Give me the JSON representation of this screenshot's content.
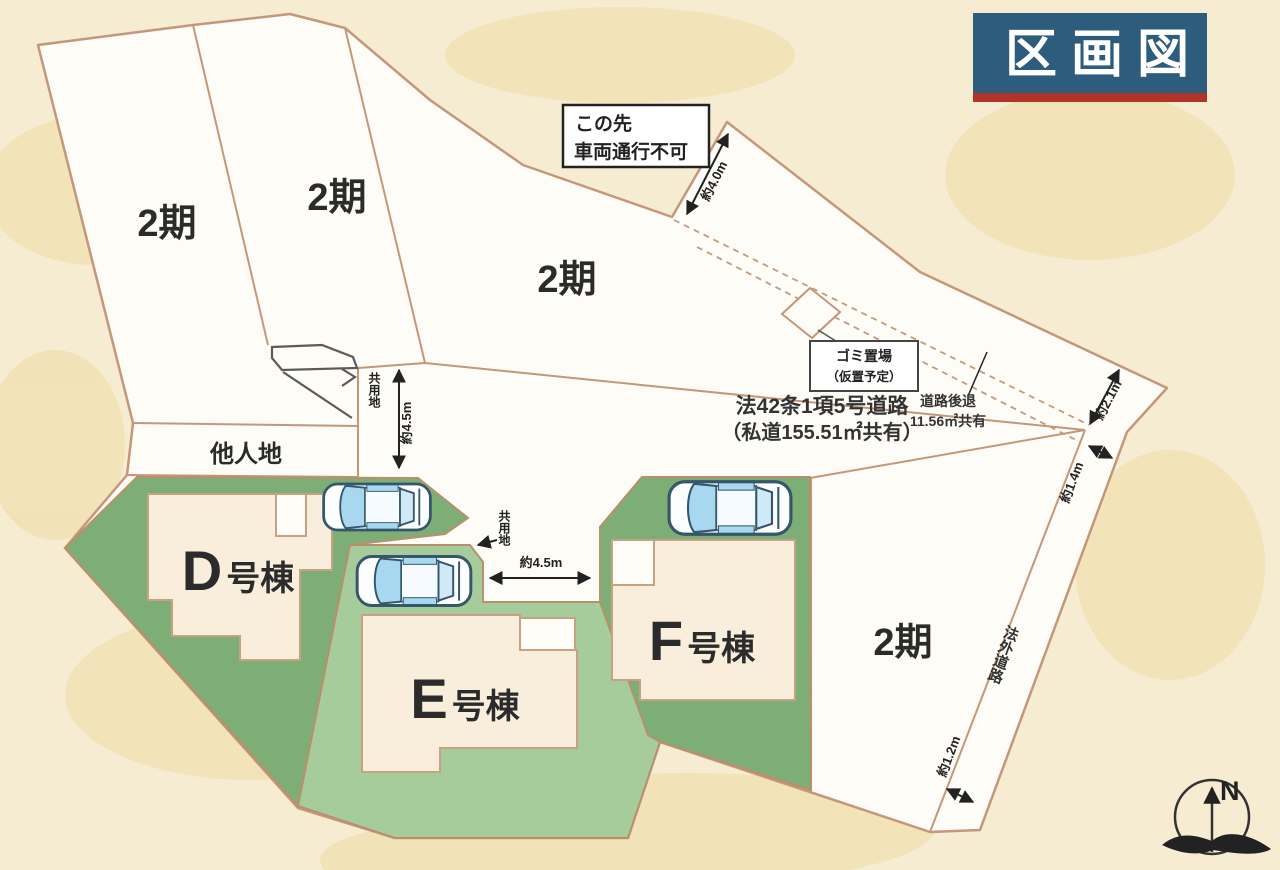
{
  "title": {
    "text": "区画図"
  },
  "lots": {
    "phase_label": "2期",
    "other_land": "他人地",
    "common_land": "共用地"
  },
  "buildings": {
    "d": {
      "letter": "D",
      "suffix": "号棟"
    },
    "e": {
      "letter": "E",
      "suffix": "号棟"
    },
    "f": {
      "letter": "F",
      "suffix": "号棟"
    }
  },
  "notice": {
    "line1": "この先",
    "line2": "車両通行不可"
  },
  "garbage": {
    "line1": "ゴミ置場",
    "line2": "（仮置予定）"
  },
  "road": {
    "line1": "法42条1項5号道路",
    "line2": "（私道155.51㎡共有）"
  },
  "setback": {
    "line1": "道路後退",
    "line2": "11.56㎡共有"
  },
  "outside_road": "法外道路",
  "dimensions": {
    "d40": "約4.0m",
    "d45_left": "約4.5m",
    "d45_mid": "約4.5m",
    "d21": "約2.1m",
    "d14": "約1.4m",
    "d12": "約1.2m"
  },
  "compass": {
    "north": "N"
  },
  "colors": {
    "background": "#f6ecd2",
    "parcel_fill": "#fefcf6",
    "lot_line": "#c4977a",
    "green_dark": "#7dae76",
    "green_light": "#a6cc9c",
    "building_fill": "#f8eedb",
    "title_bg": "#2e5c7d",
    "title_accent": "#b03527",
    "car_glass": "#a8d8ef"
  }
}
